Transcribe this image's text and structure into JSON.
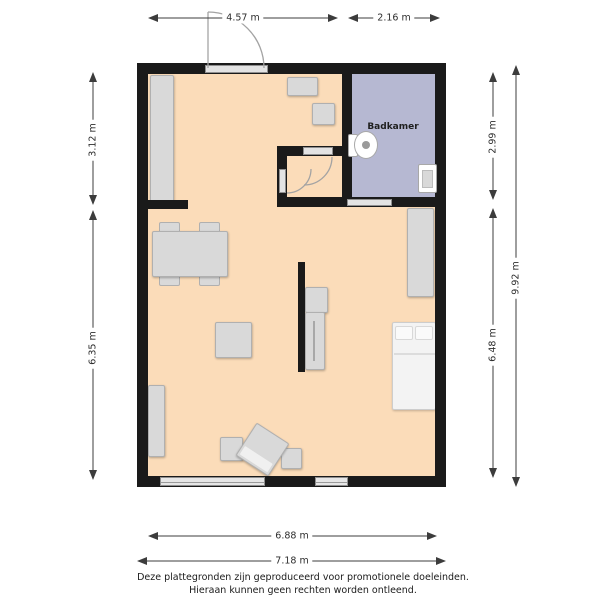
{
  "floorplan": {
    "rooms": {
      "bathroom_label": "Badkamer"
    },
    "dimensions": {
      "top_left": "4.57 m",
      "top_right": "2.16 m",
      "left_upper": "3.12 m",
      "left_lower": "6.35 m",
      "right_upper": "2.99 m",
      "right_lower": "6.48 m",
      "right_total": "9.92 m",
      "bottom_inner": "6.88 m",
      "bottom_outer": "7.18 m"
    },
    "colors": {
      "wall": "#1a1a1a",
      "floor_main": "#fbdcb9",
      "floor_bathroom": "#b6b8d2",
      "furniture": "#d9d9d9",
      "accent_line": "#3c3c3c"
    }
  },
  "footer": {
    "line1": "Deze plattegronden zijn geproduceerd voor promotionele doeleinden.",
    "line2": "Hieraan kunnen geen rechten worden ontleend."
  }
}
